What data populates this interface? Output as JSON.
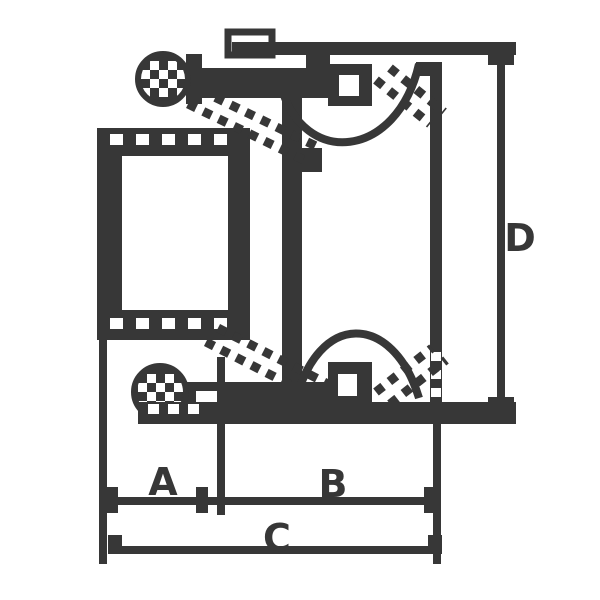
{
  "drawing": {
    "kind": "technical-cross-section",
    "colors": {
      "line": "#373737",
      "background": "#ffffff"
    },
    "labels": {
      "dim_a": "A",
      "dim_b": "B",
      "dim_c": "C",
      "dim_d": "D"
    }
  }
}
